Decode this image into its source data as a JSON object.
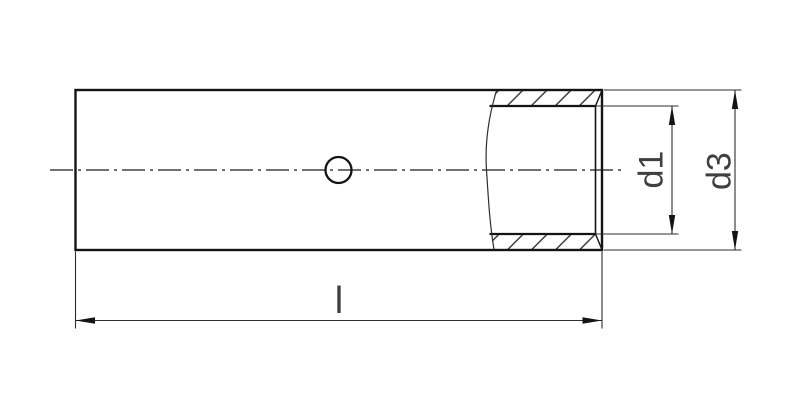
{
  "drawing": {
    "labels": {
      "length": "l",
      "inner_diameter": "d1",
      "outer_diameter": "d3"
    },
    "colors": {
      "background": "#ffffff",
      "outline": "#141414",
      "thin_line": "#2e2e2e",
      "text": "#3f3f3f"
    }
  }
}
